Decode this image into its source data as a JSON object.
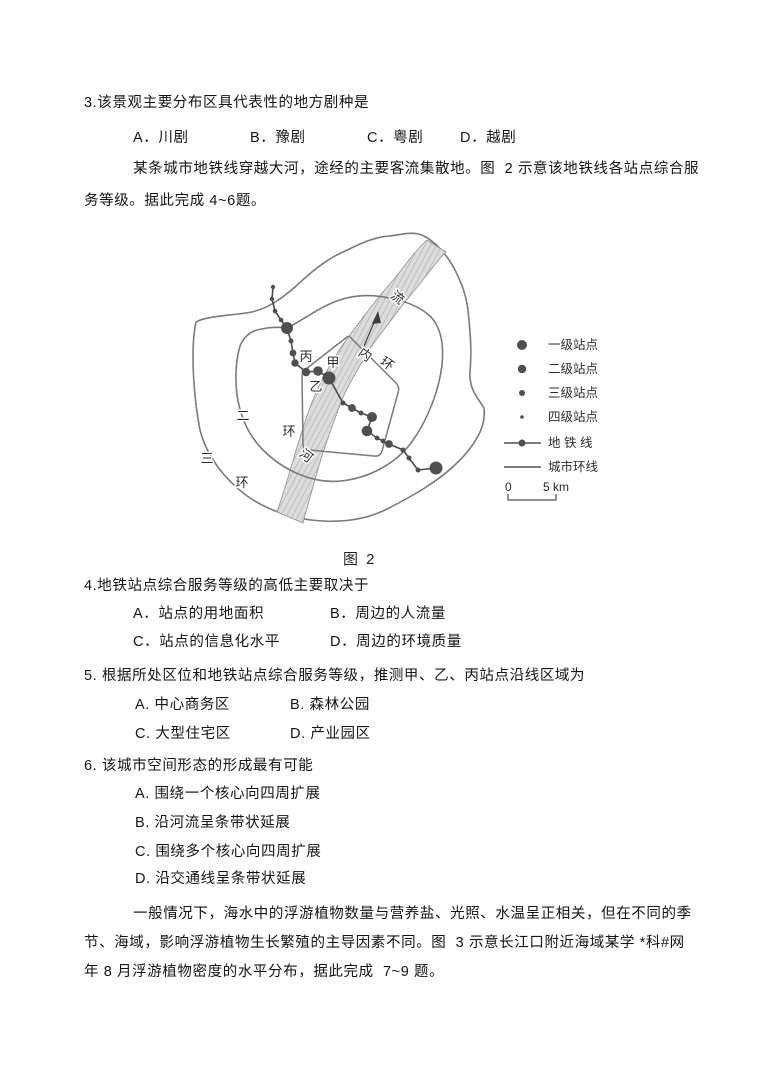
{
  "q3": {
    "text": "3.该景观主要分布区具代表性的地方剧种是",
    "options": [
      "A．川剧",
      "B．豫剧",
      "C．粤剧",
      "D．越剧"
    ]
  },
  "intro1": {
    "line1": "某条城市地铁线穿越大河，途经的主要客流集散地。图  2 示意该地铁线各站点综合服",
    "line2": "务等级。据此完成 4~6题。"
  },
  "figure": {
    "caption": "图 2",
    "labels": {
      "station_bing": "丙",
      "station_jia": "甲",
      "station_yi": "乙",
      "inner_ring": [
        "内",
        "环"
      ],
      "second_ring": [
        "二",
        "环"
      ],
      "third_ring": [
        "三",
        "环"
      ],
      "river": "河",
      "flow": "流"
    },
    "legend": {
      "items": [
        "一级站点",
        "二级站点",
        "三级站点",
        "四级站点",
        "地 铁 线",
        "城市环线"
      ],
      "scale_zero": "0",
      "scale_label": "5 km"
    },
    "colors": {
      "station": "#4f4f4f",
      "metro_line": "#4a4a4a",
      "ring_line": "#7a7a7a",
      "river_fill": "#dcdcdc",
      "river_hatch": "#a6a6a6"
    },
    "stations": [
      [
        273,
        287,
        2.2
      ],
      [
        272,
        299,
        2.2
      ],
      [
        275,
        311,
        2.3
      ],
      [
        281,
        320,
        2.3
      ],
      [
        287,
        328,
        6.0
      ],
      [
        291,
        341,
        2.5
      ],
      [
        293,
        353,
        3.4
      ],
      [
        295,
        363,
        3.7
      ],
      [
        306,
        372,
        4.3
      ],
      [
        318,
        371,
        4.8
      ],
      [
        329,
        378,
        6.5
      ],
      [
        343,
        403,
        2.5
      ],
      [
        352,
        408,
        3.9
      ],
      [
        361,
        413,
        2.5
      ],
      [
        372,
        417,
        5.0
      ],
      [
        367,
        431,
        5.3
      ],
      [
        377,
        438,
        2.4
      ],
      [
        383,
        441,
        2.4
      ],
      [
        389,
        444,
        3.9
      ],
      [
        403,
        450,
        2.5
      ],
      [
        409,
        458,
        2.5
      ],
      [
        418,
        470,
        2.5
      ],
      [
        436,
        468,
        6.5
      ]
    ]
  },
  "q4": {
    "text": "4.地铁站点综合服务等级的高低主要取决于",
    "options": [
      "A．站点的用地面积",
      "B．周边的人流量",
      "C．站点的信息化水平",
      "D．周边的环境质量"
    ]
  },
  "q5": {
    "text": "5. 根据所处区位和地铁站点综合服务等级，推测甲、乙、丙站点沿线区域为",
    "options": [
      "A. 中心商务区",
      "B. 森林公园",
      "C. 大型住宅区",
      "D. 产业园区"
    ]
  },
  "q6": {
    "text": "6. 该城市空间形态的形成最有可能",
    "options": [
      "A. 围绕一个核心向四周扩展",
      "B. 沿河流呈条带状延展",
      "C. 围绕多个核心向四周扩展",
      "D. 沿交通线呈条带状延展"
    ]
  },
  "intro2": {
    "line1": "一般情况下，海水中的浮游植物数量与营养盐、光照、水温呈正相关，但在不同的季",
    "line2": "节、海域，影响浮游植物生长繁殖的主导因素不同。图  3 示意长江口附近海域某学 *科#网",
    "line3": "年 8 月浮游植物密度的水平分布，据此完成  7~9 题。"
  }
}
